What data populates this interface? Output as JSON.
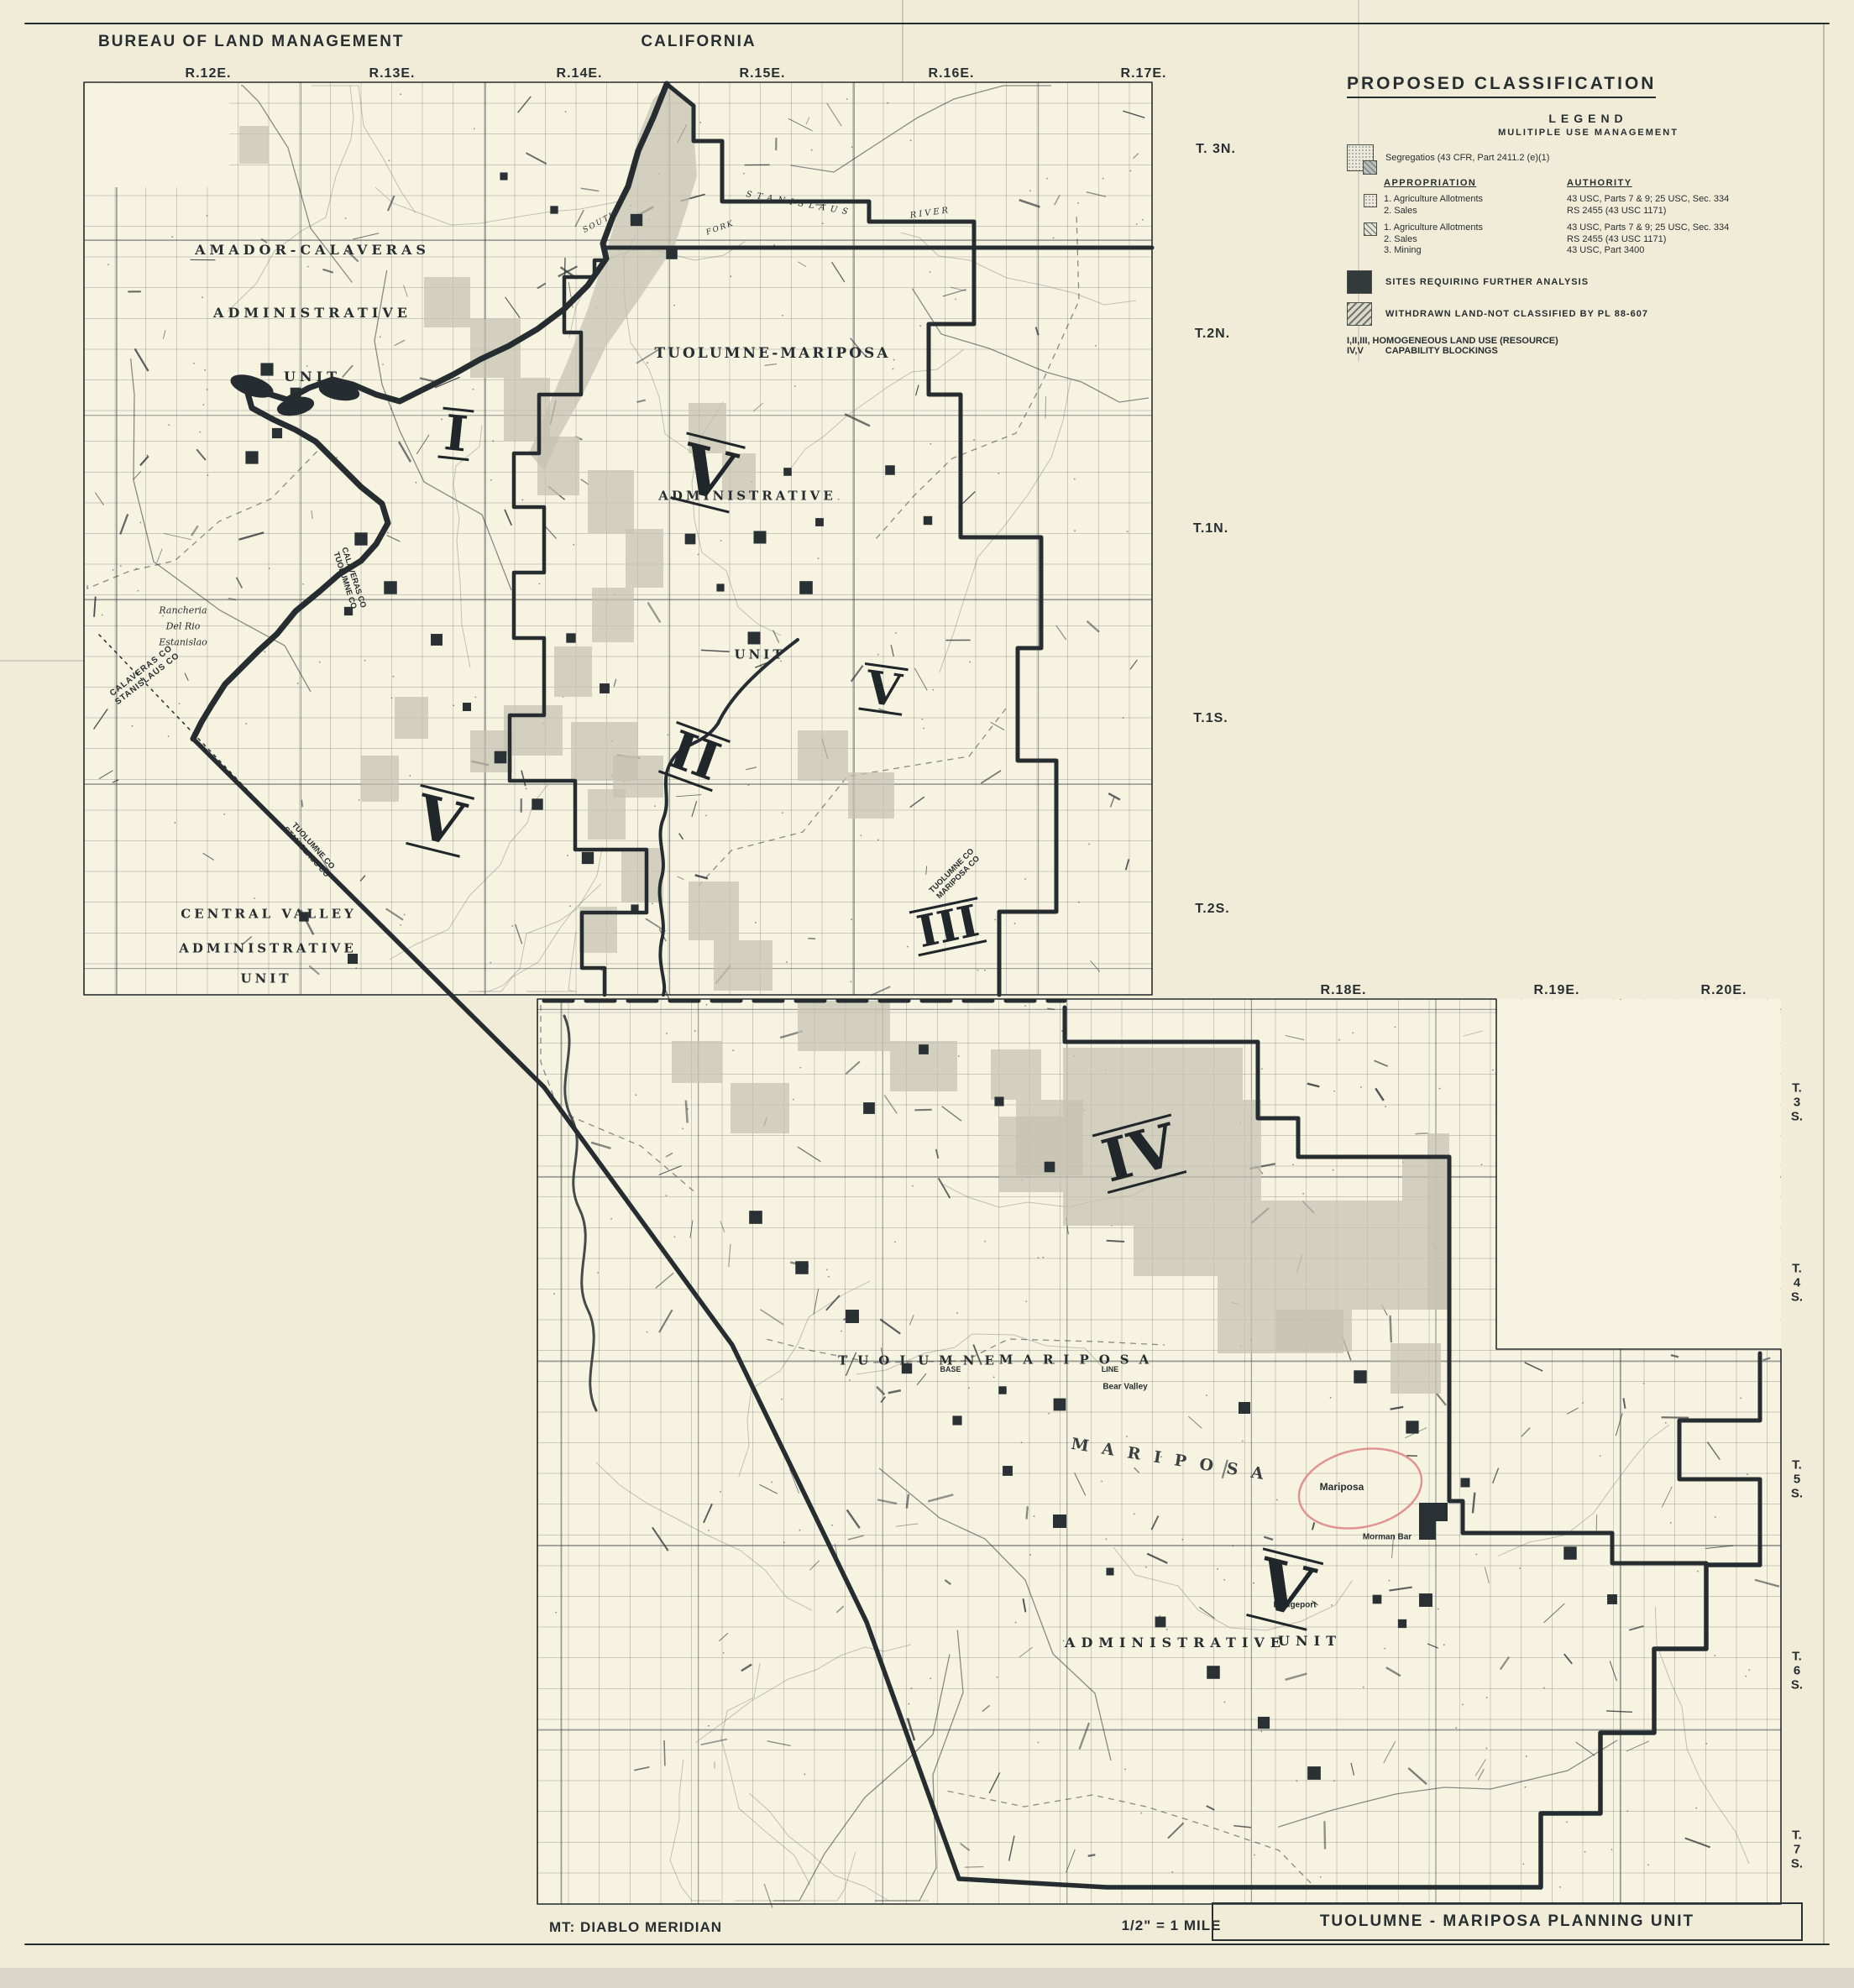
{
  "header": {
    "agency": "BUREAU OF LAND MANAGEMENT",
    "state": "CALIFORNIA"
  },
  "ranges_top": [
    "R.12E.",
    "R.13E.",
    "R.14E.",
    "R.15E.",
    "R.16E.",
    "R.17E."
  ],
  "ranges_mid": [
    "R.18E.",
    "R.19E.",
    "R.20E."
  ],
  "townships_upper": [
    "T. 3N.",
    "T.2N.",
    "T.1N.",
    "T.1S.",
    "T.2S."
  ],
  "townships_lower": [
    [
      "T.",
      "3",
      "S."
    ],
    [
      "T.",
      "4",
      "S."
    ],
    [
      "T.",
      "5",
      "S."
    ],
    [
      "T.",
      "6",
      "S."
    ],
    [
      "T.",
      "7",
      "S."
    ]
  ],
  "legend": {
    "title": "PROPOSED CLASSIFICATION",
    "heading": "LEGEND",
    "subheading": "MULITIPLE USE MANAGEMENT",
    "segregation_note": "Segregatios (43 CFR, Part 2411.2 (e)(1)",
    "col1": "APPROPRIATION",
    "col2": "AUTHORITY",
    "rows": [
      {
        "items": [
          "1. Agriculture Allotments",
          "2. Sales"
        ],
        "authority": [
          "43 USC, Parts 7 & 9; 25 USC, Sec. 334",
          "RS 2455 (43 USC 1171)"
        ]
      },
      {
        "items": [
          "1. Agriculture Allotments",
          "2. Sales",
          "3. Mining"
        ],
        "authority": [
          "43 USC, Parts 7 & 9; 25 USC, Sec. 334",
          "RS 2455 (43 USC 1171)",
          "43 USC, Part 3400"
        ]
      }
    ],
    "sites": "SITES REQUIRING FURTHER ANALYSIS",
    "withdrawn": "WITHDRAWN LAND-NOT CLASSIFIED BY PL 88-607",
    "homogeneous_1": "I,II,III, HOMOGENEOUS LAND USE (RESOURCE)",
    "homogeneous_2": "IV,V",
    "homogeneous_3": "CAPABILITY BLOCKINGS"
  },
  "map": {
    "amador": [
      "AMADOR-CALAVERAS",
      "ADMINISTRATIVE",
      "UNIT"
    ],
    "rancheria": [
      "Rancheria",
      "Del Rio",
      "Estanislao"
    ],
    "calaveras_stanislaus": [
      "CALAVERAS CO",
      "STANISLAUS CO"
    ],
    "calaveras_tuolumne": [
      "CALAVERAS CO",
      "TUOLUMNE CO"
    ],
    "tuolumne_stanislaus": [
      "TUOLUMNE CO",
      "STANISLAUS CO"
    ],
    "tuolumne_mariposa_co": [
      "TUOLUMNE CO",
      "MARIPOSA CO"
    ],
    "unit_name": "TUOLUMNE-MARIPOSA",
    "unit_admin": "ADMINISTRATIVE",
    "unit_unit": "UNIT",
    "central": [
      "CENTRAL VALLEY",
      "ADMINISTRATIVE",
      "UNIT"
    ],
    "county_tuolumne": "TUOLUMNE",
    "county_mariposa": "MARIPOSA",
    "base": "BASE",
    "line": "LINE",
    "south": "SOUTH",
    "fork": "FORK",
    "river": "RIVER",
    "stanislaus": "STANISLAUS",
    "admin_lower": [
      "ADMINISTRATIVE",
      "UNIT"
    ],
    "town_mariposa": "Mariposa",
    "town_morman": "Morman Bar",
    "town_bridgeport": "Bridgeport",
    "town_bear_valley": "Bear Valley",
    "numerals": [
      "I",
      "V",
      "V",
      "II",
      "V",
      "III",
      "IV",
      "V"
    ]
  },
  "footer": {
    "meridian": "MT: DIABLO MERIDIAN",
    "scale": "1/2\" = 1 MILE",
    "sheet_title": "TUOLUMNE - MARIPOSA PLANNING UNIT"
  },
  "colors": {
    "ink": "#2b3236",
    "paper": "#f1ecd8",
    "panel": "#f7f3e1",
    "withdrawn_shade": "#c6c2b1",
    "red_circle": "#dd8a8a"
  }
}
